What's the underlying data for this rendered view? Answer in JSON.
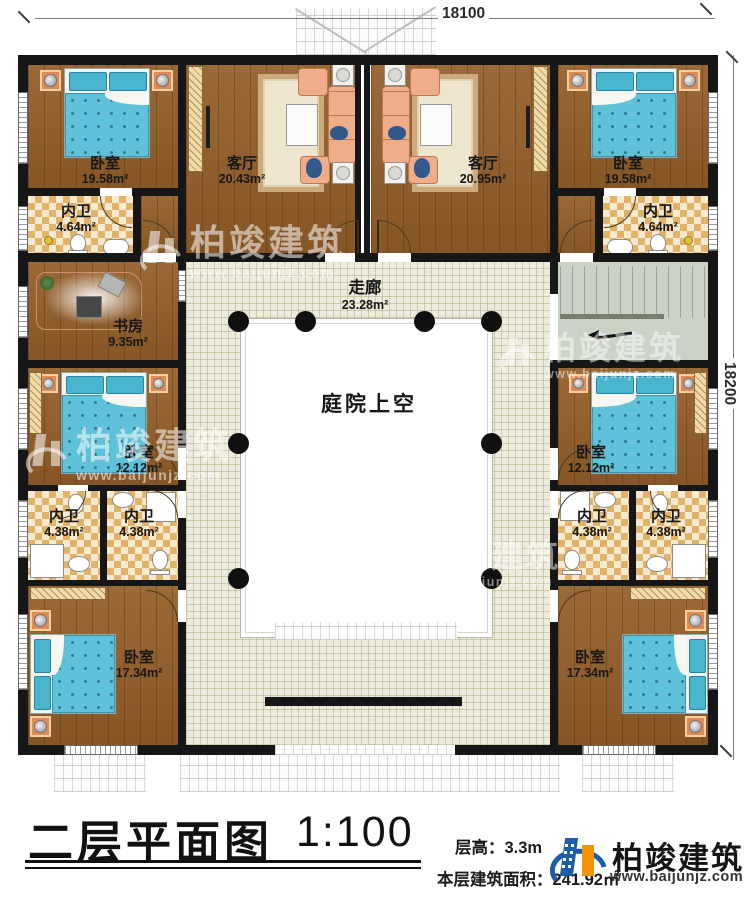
{
  "dimensions": {
    "width_label": "18100",
    "height_label": "18200"
  },
  "watermark": {
    "brand": "柏竣建筑",
    "url": "www.baijunjz.com"
  },
  "rooms": [
    {
      "name": "卧室",
      "area": "19.58m²"
    },
    {
      "name": "客厅",
      "area": "20.43m²"
    },
    {
      "name": "客厅",
      "area": "20.95m²"
    },
    {
      "name": "卧室",
      "area": "19.58m²"
    },
    {
      "name": "内卫",
      "area": "4.64m²"
    },
    {
      "name": "内卫",
      "area": "4.64m²"
    },
    {
      "name": "书房",
      "area": "9.35m²"
    },
    {
      "name": "走廊",
      "area": "23.28m²"
    },
    {
      "name": "卧室",
      "area": "12.12m²"
    },
    {
      "name": "卧室",
      "area": "12.12m²"
    },
    {
      "name": "内卫",
      "area": "4.38m²"
    },
    {
      "name": "内卫",
      "area": "4.38m²"
    },
    {
      "name": "内卫",
      "area": "4.38m²"
    },
    {
      "name": "内卫",
      "area": "4.38m²"
    },
    {
      "name": "卧室",
      "area": "17.34m²"
    },
    {
      "name": "卧室",
      "area": "17.34m²"
    },
    {
      "name": "庭院上空",
      "area": ""
    }
  ],
  "title_block": {
    "title": "二层平面图",
    "scale": "1:100",
    "floor_height": "层高：3.3m",
    "floor_area": "本层建筑面积：241.92㎡"
  },
  "brand": {
    "name": "柏竣建筑",
    "url": "www.baijunjz.com"
  }
}
